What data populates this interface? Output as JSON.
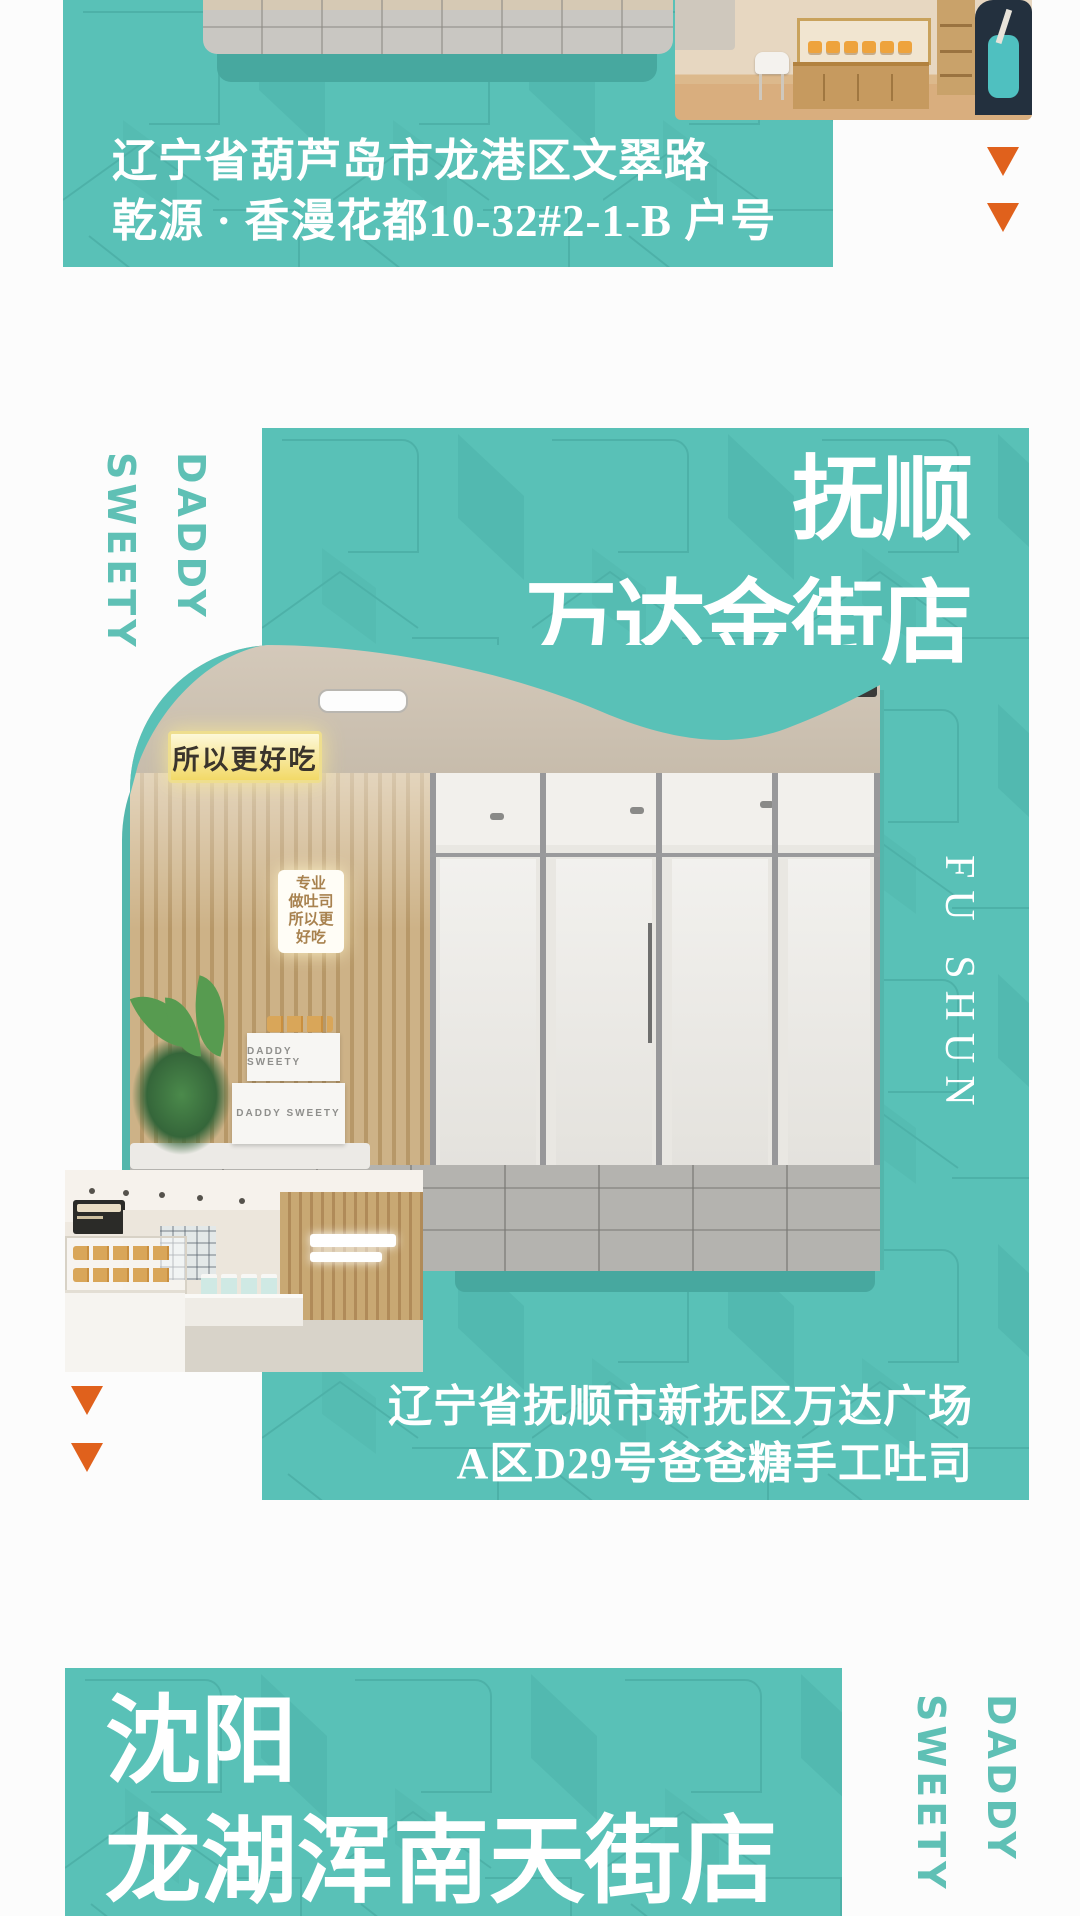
{
  "page": {
    "background": "#fcfcfc",
    "teal": "#59c1b7",
    "teal_dark": "#47a89f",
    "orange": "#e0611c",
    "brand_text_teal": "#5fc0b5",
    "headline_white": "#ffffff"
  },
  "brand": {
    "daddy": "DADDY",
    "sweety": "SWEETY"
  },
  "top_section": {
    "address_line1": "辽宁省葫芦岛市龙港区文翠路",
    "address_line2": "乾源 · 香漫花都10-32#2-1-B 户号"
  },
  "fushun_section": {
    "title_line1": "抚顺",
    "title_line2": "万达金街店",
    "latin_name": "FU SHUN",
    "address_line1": "辽宁省抚顺市新抚区万达广场",
    "address_line2": "A区D29号爸爸糖手工吐司",
    "awning_sign": "所以更好吃",
    "lightbox_line1": "专业",
    "lightbox_line2": "做吐司",
    "lightbox_line3": "所以更",
    "lightbox_line4": "好吃",
    "box_label_1": "DADDY SWEETY",
    "box_label_2": "DADDY SWEETY"
  },
  "shenyang_section": {
    "title_line1": "沈阳",
    "title_line2": "龙湖浑南天街店"
  }
}
